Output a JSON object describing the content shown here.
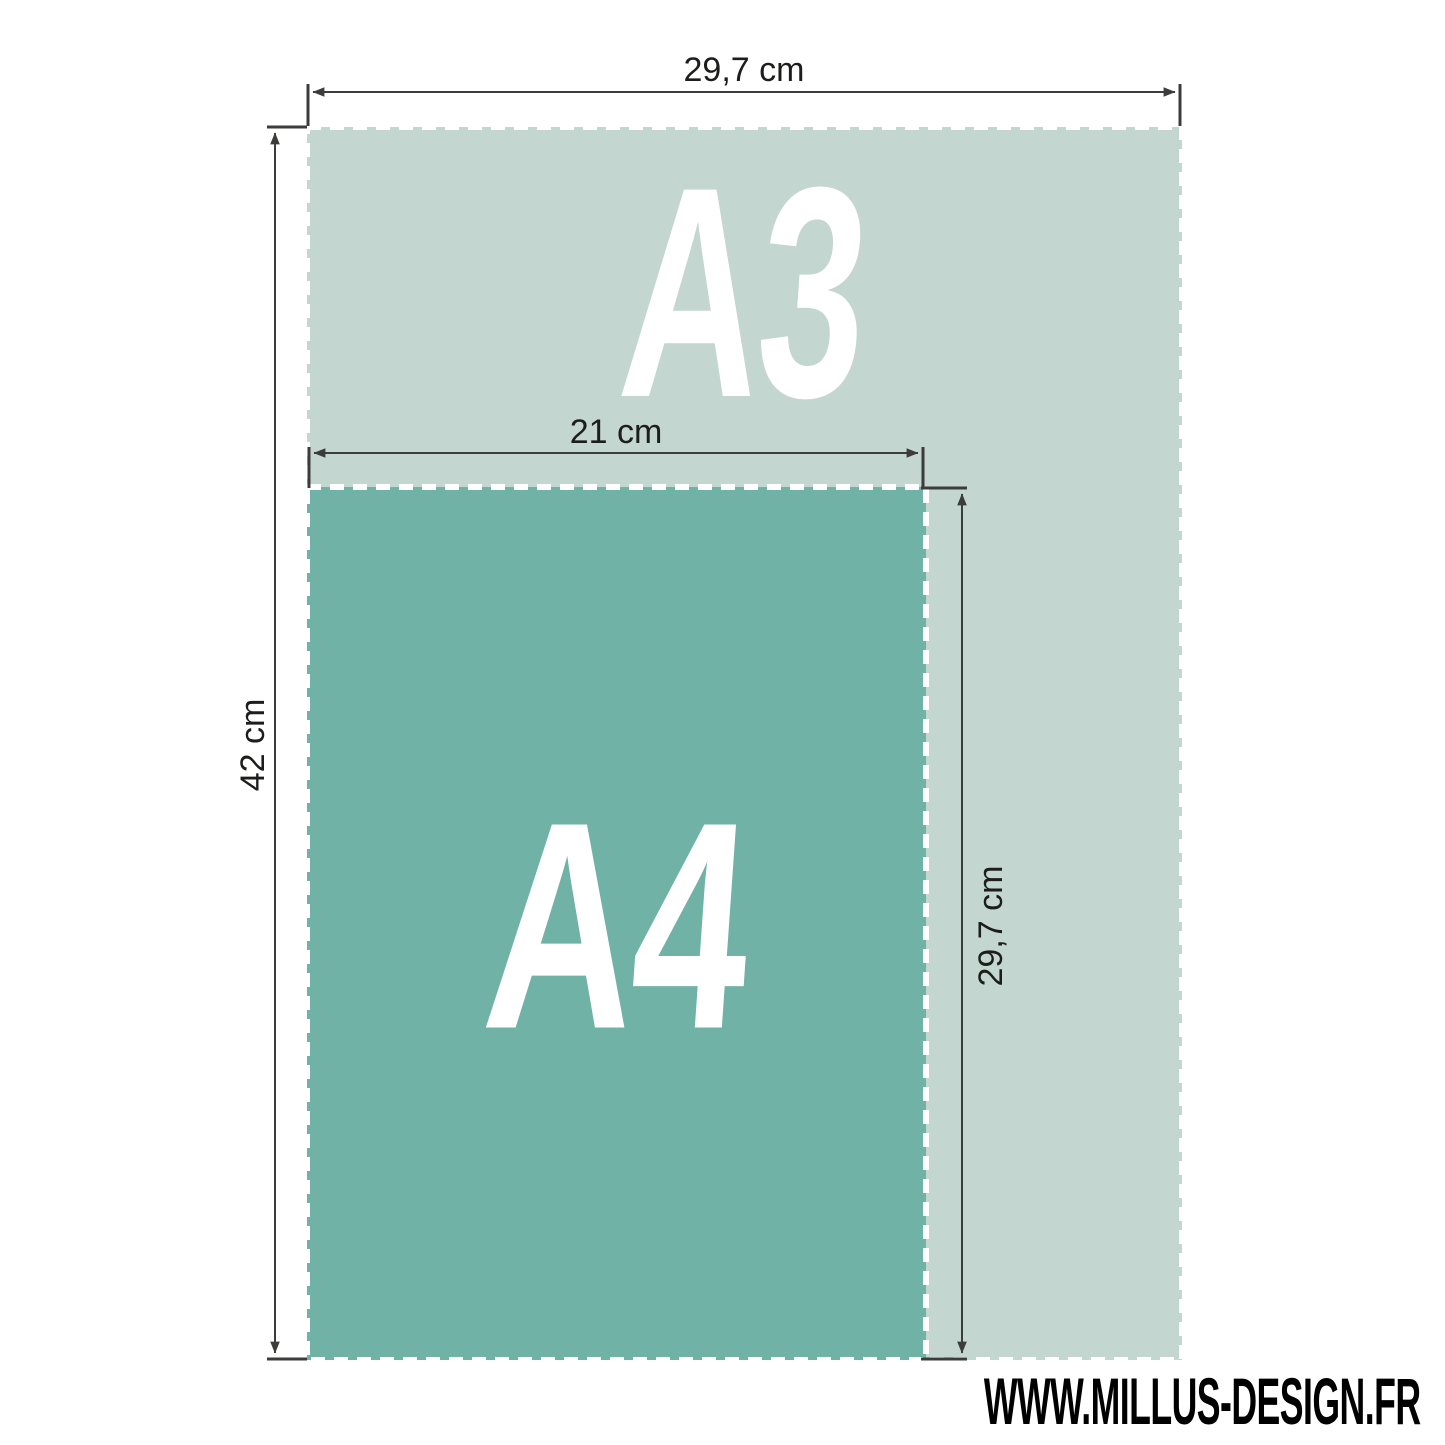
{
  "colors": {
    "background": "#ffffff",
    "sheet_border": "#ffffff",
    "dimension_line": "#3c3c3b",
    "dimension_text": "#1d1d1b",
    "sheet_label_text": "#ffffff",
    "website_text": "#000000"
  },
  "sheets": [
    {
      "id": "a3",
      "label": "A3",
      "width_label": "29,7 cm",
      "height_label": "42 cm",
      "fill": "#c3d6cf"
    },
    {
      "id": "a4",
      "label": "A4",
      "width_label": "21 cm",
      "height_label": "29,7 cm",
      "fill": "#71b2a7"
    }
  ],
  "footer": {
    "website": "WWW.MILLUS-DESIGN.FR"
  }
}
